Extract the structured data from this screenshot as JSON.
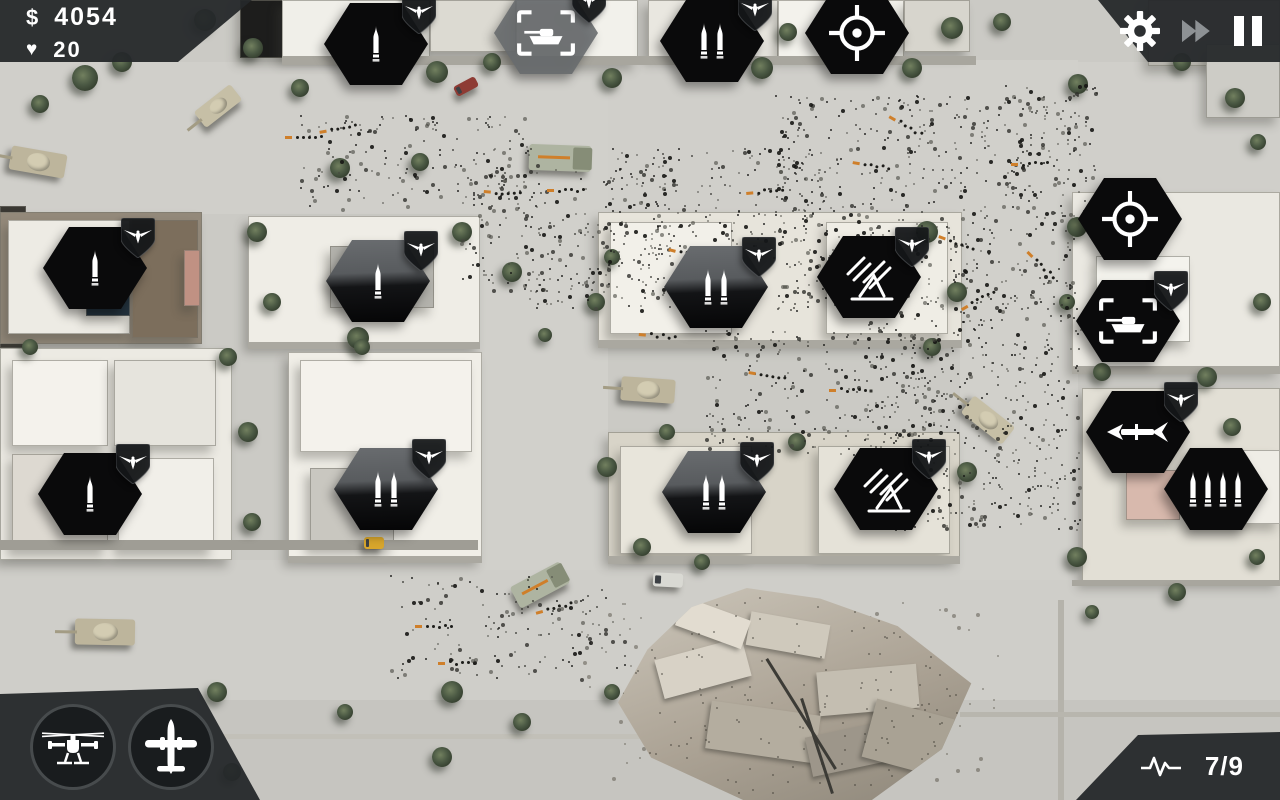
{
  "hud": {
    "money": {
      "symbol": "$",
      "value": "4054"
    },
    "lives": {
      "icon": "heart-icon",
      "glyph": "♥",
      "value": "20"
    },
    "controls": {
      "settings_icon": "settings-gear-icon",
      "fast_forward_icon": "fast-forward-icon",
      "pause_icon": "pause-icon"
    },
    "air_support": [
      {
        "icon": "attack-helicopter-icon"
      },
      {
        "icon": "airstrike-plane-icon"
      }
    ],
    "wave": {
      "icon": "wave-pulse-icon",
      "text": "7/9"
    }
  },
  "colors": {
    "panel": "#25282a",
    "hud_text": "#ffffff",
    "dim_icon": "#8d9194",
    "hex_fill": "#0a0a0b",
    "hex_ghost": "#6c7072",
    "badge_fill": "#141719",
    "accent_orange": "#cf7f2a",
    "ground": "#cbcac5",
    "road": "#d0cfca",
    "tree_green": "#4a5843",
    "armor_tan": "#c6bfa6",
    "rubble": "#aba294"
  },
  "towers": [
    {
      "cx": 376,
      "cy": 44,
      "icon": "single-bullet",
      "badge": true,
      "variant": "solid"
    },
    {
      "cx": 546,
      "cy": 33,
      "icon": "tank-target",
      "badge": true,
      "variant": "ghost"
    },
    {
      "cx": 712,
      "cy": 41,
      "icon": "double-bullet",
      "badge": true,
      "variant": "solid"
    },
    {
      "cx": 857,
      "cy": 33,
      "icon": "reticle",
      "badge": false,
      "variant": "solid"
    },
    {
      "cx": 1130,
      "cy": 219,
      "icon": "reticle",
      "badge": false,
      "variant": "solid"
    },
    {
      "cx": 1128,
      "cy": 321,
      "icon": "tank-target",
      "badge": true,
      "variant": "solid"
    },
    {
      "cx": 1138,
      "cy": 432,
      "icon": "rocket",
      "badge": true,
      "variant": "solid"
    },
    {
      "cx": 1216,
      "cy": 489,
      "icon": "quad-bullet",
      "badge": false,
      "variant": "solid"
    },
    {
      "cx": 95,
      "cy": 268,
      "icon": "single-bullet",
      "badge": true,
      "variant": "solid"
    },
    {
      "cx": 378,
      "cy": 281,
      "icon": "single-bullet",
      "badge": true,
      "variant": "duo"
    },
    {
      "cx": 90,
      "cy": 494,
      "icon": "single-bullet",
      "badge": true,
      "variant": "solid"
    },
    {
      "cx": 386,
      "cy": 489,
      "icon": "double-bullet",
      "badge": true,
      "variant": "duo"
    },
    {
      "cx": 716,
      "cy": 287,
      "icon": "double-bullet",
      "badge": true,
      "variant": "duo"
    },
    {
      "cx": 869,
      "cy": 277,
      "icon": "flak",
      "badge": true,
      "variant": "solid"
    },
    {
      "cx": 714,
      "cy": 492,
      "icon": "double-bullet",
      "badge": true,
      "variant": "duo"
    },
    {
      "cx": 886,
      "cy": 489,
      "icon": "flak",
      "badge": true,
      "variant": "solid"
    }
  ],
  "map": {
    "roads": [
      [
        0,
        62,
        1280,
        152,
        "#d0cfca"
      ],
      [
        0,
        560,
        1280,
        150,
        "#cfcec9"
      ],
      [
        480,
        60,
        128,
        510,
        "#d1d0cb"
      ],
      [
        960,
        60,
        118,
        520,
        "#d1d0cb"
      ],
      [
        0,
        700,
        1280,
        100,
        "#c6c5c0"
      ]
    ],
    "buildings": [
      [
        240,
        0,
        108,
        58,
        "#1d1d1c"
      ],
      [
        282,
        0,
        148,
        58,
        "#f0efe9"
      ],
      [
        430,
        0,
        86,
        52,
        "#dcdad2"
      ],
      [
        516,
        0,
        122,
        64,
        "#f2f1eb"
      ],
      [
        648,
        0,
        130,
        58,
        "#e9e7e0"
      ],
      [
        778,
        0,
        126,
        58,
        "#f3f2ec"
      ],
      [
        904,
        0,
        66,
        52,
        "#d7d5cd"
      ],
      [
        1148,
        0,
        132,
        66,
        "#b7b5ae"
      ],
      [
        1206,
        44,
        74,
        74,
        "#cdccc6"
      ],
      [
        0,
        206,
        26,
        142,
        "#3a3833"
      ],
      [
        0,
        212,
        202,
        132,
        "#93897a"
      ],
      [
        8,
        220,
        122,
        114,
        "#edebe4"
      ],
      [
        132,
        220,
        66,
        118,
        "#7c6e5c"
      ],
      [
        184,
        250,
        16,
        56,
        "#c09183"
      ],
      [
        86,
        274,
        44,
        42,
        "#22313c"
      ],
      [
        0,
        348,
        232,
        212,
        "#eceae3"
      ],
      [
        12,
        360,
        96,
        86,
        "#f4f2ec"
      ],
      [
        114,
        360,
        102,
        86,
        "#e6e4dd"
      ],
      [
        12,
        454,
        96,
        96,
        "#ddd9d1"
      ],
      [
        118,
        458,
        96,
        92,
        "#f1efe9"
      ],
      [
        248,
        216,
        232,
        130,
        "#efede6"
      ],
      [
        330,
        246,
        104,
        62,
        "#b3b2ac"
      ],
      [
        288,
        352,
        194,
        208,
        "#f0eee7"
      ],
      [
        300,
        360,
        172,
        92,
        "#f4f2ec"
      ],
      [
        310,
        468,
        84,
        80,
        "#c9c7c0"
      ],
      [
        598,
        212,
        364,
        132,
        "#e7e4db"
      ],
      [
        610,
        222,
        122,
        112,
        "#f2f0e9"
      ],
      [
        826,
        222,
        122,
        112,
        "#efede5"
      ],
      [
        608,
        432,
        352,
        128,
        "#d8d4c8"
      ],
      [
        620,
        446,
        132,
        108,
        "#e8e5db"
      ],
      [
        818,
        446,
        132,
        108,
        "#e5e2d8"
      ],
      [
        1072,
        192,
        208,
        178,
        "#eae8e1"
      ],
      [
        1096,
        256,
        94,
        86,
        "#f4f3ed"
      ],
      [
        1082,
        388,
        198,
        194,
        "#e2dfd5"
      ],
      [
        1126,
        470,
        54,
        50,
        "#d8b9ad"
      ],
      [
        1194,
        450,
        86,
        74,
        "#efede6"
      ]
    ],
    "walls": [
      [
        282,
        56,
        694,
        9,
        "#a8a69e"
      ],
      [
        0,
        540,
        478,
        10,
        "#9f9d95"
      ],
      [
        598,
        340,
        364,
        8,
        "#aaa8a0"
      ],
      [
        608,
        556,
        352,
        8,
        "#aaa8a0"
      ],
      [
        1072,
        366,
        208,
        8,
        "#aaa8a0"
      ],
      [
        248,
        342,
        232,
        7,
        "#aaa8a0"
      ],
      [
        288,
        556,
        194,
        7,
        "#aaa8a0"
      ],
      [
        150,
        734,
        700,
        5,
        "#c2c0b8"
      ],
      [
        1058,
        600,
        6,
        200,
        "#b5b3ab"
      ],
      [
        960,
        712,
        320,
        5,
        "#b8b6ae"
      ],
      [
        1072,
        580,
        208,
        6,
        "#a8a69e"
      ]
    ],
    "trees": [
      [
        85,
        78,
        26
      ],
      [
        122,
        62,
        20
      ],
      [
        40,
        104,
        18
      ],
      [
        205,
        20,
        22
      ],
      [
        253,
        48,
        20
      ],
      [
        300,
        88,
        18
      ],
      [
        340,
        168,
        20
      ],
      [
        420,
        162,
        18
      ],
      [
        437,
        72,
        22
      ],
      [
        492,
        62,
        18
      ],
      [
        612,
        78,
        20
      ],
      [
        762,
        68,
        22
      ],
      [
        788,
        32,
        18
      ],
      [
        912,
        68,
        20
      ],
      [
        952,
        28,
        22
      ],
      [
        1002,
        22,
        18
      ],
      [
        1078,
        84,
        20
      ],
      [
        1182,
        62,
        18
      ],
      [
        1235,
        98,
        20
      ],
      [
        1258,
        142,
        16
      ],
      [
        257,
        232,
        20
      ],
      [
        272,
        302,
        18
      ],
      [
        358,
        338,
        22
      ],
      [
        462,
        232,
        20
      ],
      [
        30,
        347,
        16
      ],
      [
        228,
        357,
        18
      ],
      [
        248,
        432,
        20
      ],
      [
        252,
        522,
        18
      ],
      [
        362,
        347,
        16
      ],
      [
        512,
        272,
        20
      ],
      [
        596,
        302,
        18
      ],
      [
        612,
        257,
        16
      ],
      [
        927,
        232,
        22
      ],
      [
        957,
        292,
        20
      ],
      [
        932,
        347,
        18
      ],
      [
        607,
        467,
        20
      ],
      [
        642,
        547,
        18
      ],
      [
        702,
        562,
        16
      ],
      [
        797,
        442,
        18
      ],
      [
        967,
        472,
        20
      ],
      [
        667,
        432,
        16
      ],
      [
        545,
        335,
        14
      ],
      [
        1077,
        227,
        20
      ],
      [
        1102,
        372,
        18
      ],
      [
        1207,
        377,
        20
      ],
      [
        1232,
        427,
        18
      ],
      [
        1067,
        302,
        16
      ],
      [
        1262,
        302,
        18
      ],
      [
        1077,
        557,
        20
      ],
      [
        1177,
        592,
        18
      ],
      [
        1257,
        557,
        16
      ],
      [
        1092,
        612,
        14
      ],
      [
        217,
        692,
        20
      ],
      [
        452,
        692,
        22
      ],
      [
        442,
        757,
        20
      ],
      [
        522,
        722,
        18
      ],
      [
        612,
        692,
        16
      ],
      [
        702,
        682,
        14
      ],
      [
        232,
        772,
        18
      ],
      [
        345,
        712,
        16
      ]
    ],
    "vehicles": [
      [
        38,
        162,
        56,
        24,
        10,
        "tank"
      ],
      [
        218,
        106,
        46,
        20,
        -38,
        "apc"
      ],
      [
        560,
        158,
        62,
        26,
        2,
        "truck"
      ],
      [
        648,
        390,
        54,
        24,
        4,
        "tank"
      ],
      [
        988,
        420,
        52,
        22,
        38,
        "apc"
      ],
      [
        105,
        632,
        60,
        26,
        1,
        "tank"
      ],
      [
        540,
        585,
        56,
        24,
        -28,
        "truck"
      ],
      [
        668,
        580,
        30,
        14,
        3,
        "car"
      ],
      [
        466,
        86,
        24,
        11,
        -28,
        "car_red"
      ],
      [
        374,
        543,
        20,
        12,
        0,
        "car_yellow"
      ]
    ],
    "swarms": [
      [
        300,
        115,
        230,
        95,
        0.008,
        "dark"
      ],
      [
        460,
        165,
        205,
        135,
        0.008,
        "dark"
      ],
      [
        612,
        148,
        210,
        112,
        0.008,
        "dark"
      ],
      [
        775,
        95,
        300,
        215,
        0.009,
        "dark"
      ],
      [
        865,
        295,
        215,
        235,
        0.009,
        "dark"
      ],
      [
        525,
        225,
        150,
        85,
        0.007,
        "dark"
      ],
      [
        705,
        330,
        230,
        125,
        0.008,
        "dark"
      ],
      [
        390,
        575,
        235,
        105,
        0.006,
        "dark"
      ],
      [
        1005,
        85,
        92,
        130,
        0.007,
        "dark"
      ],
      [
        580,
        600,
        420,
        180,
        0.0015,
        "light"
      ]
    ],
    "squads": [
      [
        330,
        128,
        -10
      ],
      [
        495,
        190,
        5
      ],
      [
        558,
        188,
        0
      ],
      [
        757,
        190,
        -5
      ],
      [
        864,
        162,
        10
      ],
      [
        1022,
        162,
        0
      ],
      [
        426,
        624,
        0
      ],
      [
        449,
        661,
        0
      ],
      [
        546,
        608,
        -15
      ],
      [
        650,
        333,
        5
      ],
      [
        840,
        388,
        0
      ],
      [
        950,
        238,
        20
      ],
      [
        970,
        302,
        -30
      ],
      [
        760,
        372,
        10
      ],
      [
        1037,
        258,
        45
      ],
      [
        296,
        135,
        0
      ],
      [
        680,
        250,
        15
      ],
      [
        900,
        120,
        30
      ]
    ],
    "rubble_slabs": [
      [
        40,
        60,
        90,
        40,
        -15,
        "#d8d2c6"
      ],
      [
        130,
        30,
        80,
        34,
        10,
        "#cfc9bc"
      ],
      [
        200,
        80,
        100,
        44,
        -5,
        "#c4beb1"
      ],
      [
        90,
        120,
        110,
        48,
        8,
        "#b4ad9f"
      ],
      [
        190,
        140,
        90,
        40,
        -12,
        "#9d968a"
      ],
      [
        60,
        20,
        70,
        30,
        20,
        "#e2dcd0"
      ],
      [
        250,
        120,
        80,
        60,
        15,
        "#a9a294"
      ]
    ],
    "rubble_poles": [
      [
        150,
        70,
        130,
        3,
        58
      ],
      [
        185,
        110,
        100,
        3,
        72
      ]
    ]
  }
}
